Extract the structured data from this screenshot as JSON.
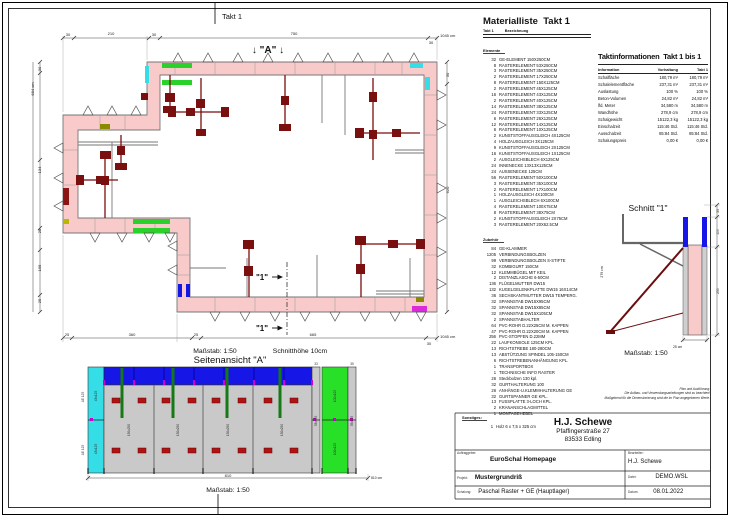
{
  "plan": {
    "title": "Takt 1",
    "marker_a": "↓ \"A\" ↓",
    "cut_label": "\"1\"",
    "scale_label": "Maßstab: 1:50",
    "cut_height_label": "Schnitthöhe 10cm",
    "dims": {
      "top": [
        "30",
        "210",
        "30",
        "750",
        "30"
      ],
      "top_total": "1045 cm",
      "bottom": [
        "25",
        "360",
        "25",
        "665",
        "30"
      ],
      "bottom_total": "1045 cm",
      "left": [
        "30",
        "134",
        "25",
        "195",
        "25"
      ],
      "left_total": "684 cm",
      "right": [
        "30",
        "620"
      ]
    }
  },
  "elevation": {
    "title": "Seitenansicht \"A\"",
    "scale": "Maßstab: 1:50",
    "dim_total": "810",
    "dim_total_unit": "810 cm",
    "col_dims": [
      "33",
      "35"
    ],
    "labels": {
      "left_outer": "AE 125",
      "cyan": "43x125",
      "gray": "150x250",
      "green": "100x125",
      "right_gray1": "33x125",
      "right_gray2": "35x125"
    }
  },
  "section": {
    "title": "Schnitt \"1\"",
    "scale": "Maßstab: 1:50",
    "height_label": "279 cm",
    "dims": {
      "d35": "35",
      "d100": "100",
      "d250": "250",
      "d25": "25 cm"
    }
  },
  "material_list": {
    "title": "Materialliste  Takt 1",
    "col_takt": "Takt 1",
    "col_name": "Bezeichnung",
    "groups": [
      {
        "name": "Elemente",
        "items": [
          {
            "qty": "32",
            "name": "GE-ELEMENT 150X250CM"
          },
          {
            "qty": "8",
            "name": "RASTERELEMENT 53X250CM"
          },
          {
            "qty": "3",
            "name": "RASTERELEMENT 35X250CM"
          },
          {
            "qty": "2",
            "name": "RASTERELEMENT 17X250CM"
          },
          {
            "qty": "8",
            "name": "RASTERELEMENT 150X125CM"
          },
          {
            "qty": "2",
            "name": "RASTERELEMENT 45X125CM"
          },
          {
            "qty": "16",
            "name": "RASTERELEMENT 43X125CM"
          },
          {
            "qty": "2",
            "name": "RASTERELEMENT 40X125CM"
          },
          {
            "qty": "14",
            "name": "RASTERELEMENT 38X125CM"
          },
          {
            "qty": "24",
            "name": "RASTERELEMENT 33X125CM"
          },
          {
            "qty": "6",
            "name": "RASTERELEMENT 26X125CM"
          },
          {
            "qty": "12",
            "name": "RASTERELEMENT 14X125CM"
          },
          {
            "qty": "6",
            "name": "RASTERELEMENT 10X125CM"
          },
          {
            "qty": "2",
            "name": "KUNSTSTOFFAUSGLEICH 4X125CM"
          },
          {
            "qty": "4",
            "name": "HOLZAUSGLEICH 3X125CM"
          },
          {
            "qty": "9",
            "name": "KUNSTSTOFFAUSGLEICH 2X125CM"
          },
          {
            "qty": "16",
            "name": "KUNSTSTOFFAUSGLEICH 1X125CM"
          },
          {
            "qty": "2",
            "name": "AUSGLEICHSBLECH 6X125CM"
          },
          {
            "qty": "24",
            "name": "INNENECKE 13X13X125CM"
          },
          {
            "qty": "24",
            "name": "AUSSENECKE 125CM"
          },
          {
            "qty": "56",
            "name": "RASTERELEMENT 50X100CM"
          },
          {
            "qty": "3",
            "name": "RASTERELEMENT 35X100CM"
          },
          {
            "qty": "2",
            "name": "RASTERELEMENT 17X100CM"
          },
          {
            "qty": "1",
            "name": "HOLZAUSGLEICH 4X100CM"
          },
          {
            "qty": "1",
            "name": "AUSGLEICHSBLECH 6X100CM"
          },
          {
            "qty": "4",
            "name": "RASTERELEMENT 100X75CM"
          },
          {
            "qty": "8",
            "name": "RASTERELEMENT 38X75CM"
          },
          {
            "qty": "2",
            "name": "KUNSTSTOFFAUSGLEICH 2X75CM"
          },
          {
            "qty": "3",
            "name": "RASTERELEMENT 20X62.5CM"
          }
        ]
      },
      {
        "name": "Zubehör",
        "items": [
          {
            "qty": "84",
            "name": "GE-KLAMMER"
          },
          {
            "qty": "1205",
            "name": "VERBINDUNGSBOLZEN"
          },
          {
            "qty": "99",
            "name": "VERBINDUNGSBOLZEN S-STIFTE"
          },
          {
            "qty": "32",
            "name": "KOMBIGURT 150CM"
          },
          {
            "qty": "12",
            "name": "KLEMMBÜGEL MIT KEIL"
          },
          {
            "qty": "2",
            "name": "DISTANZLASCHE 6-50CM"
          },
          {
            "qty": "136",
            "name": "FLÜGELMUTTER DW15"
          },
          {
            "qty": "132",
            "name": "KUGELGELENKPLATTE DW15 16X14CM"
          },
          {
            "qty": "36",
            "name": "SECHSKANTMUTTER DW15 TEMPERG."
          },
          {
            "qty": "32",
            "name": "SPANNSTAB DW15X95CM"
          },
          {
            "qty": "32",
            "name": "SPANNSTAB DW15X85CM"
          },
          {
            "qty": "32",
            "name": "SPANNSTAB DW15X105CM"
          },
          {
            "qty": "2",
            "name": "SPANNSTABHALTER"
          },
          {
            "qty": "64",
            "name": "PVC-ROHR D.22X25CM M. KAPPEN"
          },
          {
            "qty": "47",
            "name": "PVC-ROHR D.22X20CM M. KAPPEN"
          },
          {
            "qty": "256",
            "name": "PVC-STOPFEN D.22MM"
          },
          {
            "qty": "22",
            "name": "LAUFKONSOLE 125CM KPL."
          },
          {
            "qty": "13",
            "name": "RICHTSTREBE 180-280CM"
          },
          {
            "qty": "13",
            "name": "ABSTÜTZUNG SPINDEL 105-150CM"
          },
          {
            "qty": "6",
            "name": "RICHTSTREBENANHÄNGUNG KPL."
          },
          {
            "qty": "1",
            "name": "TRANSPORTBOX"
          },
          {
            "qty": "1",
            "name": "TECHNISCHE INFO RASTER"
          },
          {
            "qty": "26",
            "name": "Steckbolzen 130 kpl."
          },
          {
            "qty": "32",
            "name": "GURTHALTERUNG 100"
          },
          {
            "qty": "26",
            "name": "ANHÄNGE-U.KLEMMHALTERUNG GE"
          },
          {
            "qty": "32",
            "name": "GURTSPANNER GE KPL."
          },
          {
            "qty": "13",
            "name": "FUSSPLATTE 3-LOCH KPL."
          },
          {
            "qty": "2",
            "name": "KRANANSCHLAGMITTEL"
          },
          {
            "qty": "1",
            "name": "MONTAGEHEBEL"
          }
        ]
      },
      {
        "name": "Sonstiges:",
        "items": [
          {
            "qty": "1",
            "name": "Holz 6 x 7,5 x 325 cm"
          }
        ]
      }
    ]
  },
  "takt_info": {
    "title": "Taktinformationen  Takt 1 bis 1",
    "columns": [
      "Information",
      "Vorhaltung",
      "Takt 1"
    ],
    "rows": [
      {
        "label": "Schalfläche",
        "vorhaltung": "180,79 m²",
        "takt1": "180,79 m²"
      },
      {
        "label": "Schalelementfläche",
        "vorhaltung": "237,31 m²",
        "takt1": "237,31 m²"
      },
      {
        "label": "Auslastung",
        "vorhaltung": "100 %",
        "takt1": "100 %"
      },
      {
        "label": "Beton-Volumen",
        "vorhaltung": "24,82 m³",
        "takt1": "24,82 m³"
      },
      {
        "label": "lfd. Meter",
        "vorhaltung": "34,580 m",
        "takt1": "34,580 m"
      },
      {
        "label": "Wandhöhe",
        "vorhaltung": "278,9 cm",
        "takt1": "278,9 cm"
      },
      {
        "label": "Schalgewicht",
        "vorhaltung": "15122,3 kg",
        "takt1": "15122,3 kg"
      },
      {
        "label": "Einschalzeit",
        "vorhaltung": "115:46 Std.",
        "takt1": "115:46 Std."
      },
      {
        "label": "Ausschalzeit",
        "vorhaltung": "85:84 Std.",
        "takt1": "85:84 Std."
      },
      {
        "label": "Schalungspreis",
        "vorhaltung": "0,00 €",
        "takt1": "0,00 €"
      }
    ]
  },
  "disclaimer": {
    "line1": "Plan und Ausführung:",
    "line2": "Die Aufbau- und Verwendungsanleitungen sind zu beachten!",
    "line3": "Maßgebend für die Dimensionierung sind die im Plan angegebenen Werte."
  },
  "title_block": {
    "company": "H.J. Schewe",
    "address1": "Pfaffingerstraße 27",
    "address2": "83533 Edling",
    "auftraggeber_label": "Auftraggeber:",
    "auftraggeber": "EuroSchal Homepage",
    "bearbeiter_label": "Bearbeiter:",
    "bearbeiter": "H.J. Schewe",
    "projekt_label": "Projekt:",
    "projekt": "Mustergrundriß",
    "datei_label": "Datei:",
    "datei": "DEMO.WSL",
    "schalung_label": "Schalung:",
    "schalung": "Paschal Raster + GE (Hauptlager)",
    "datum_label": "Datum:",
    "datum": "08.01.2022"
  },
  "colors": {
    "wall_pink": "#f8caca",
    "element_gray": "#c9c9c9",
    "accent_green": "#2ad12a",
    "accent_cyan": "#35dde6",
    "accent_blue": "#1616e6",
    "accent_magenta": "#d92bd9",
    "accent_olive": "#8a8a00",
    "brace_red": "#7a0f0f"
  }
}
